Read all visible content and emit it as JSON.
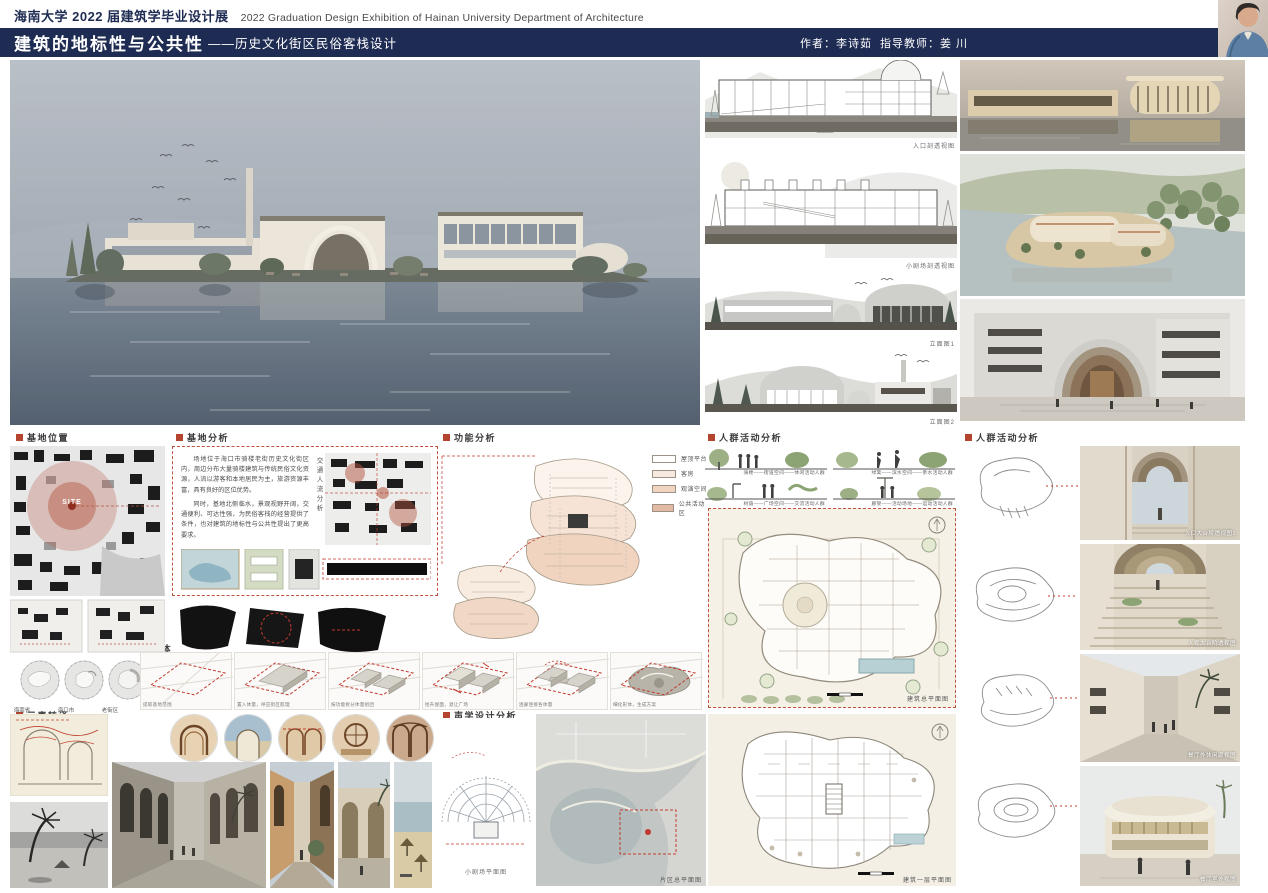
{
  "header": {
    "title_cn": "海南大学 2022 届建筑学毕业设计展",
    "title_en": "2022 Graduation Design Exhibition of Hainan University Department of Architecture"
  },
  "titlebar": {
    "main_title": "建筑的地标性与公共性",
    "subtitle": "——历史文化街区民俗客栈设计",
    "author": "作者：李诗茹",
    "advisor": "指导教师：姜  川"
  },
  "middle_column": {
    "section1_caption": "入口剖透视图",
    "section2_caption": "小剧场剖透视图",
    "elevation1_caption": "立面图1",
    "elevation2_caption": "立面图2"
  },
  "sections": {
    "site_location": "基地位置",
    "site_analysis": "基地分析",
    "function_analysis": "功能分析",
    "crowd_activity_left": "人群活动分析",
    "crowd_activity_right": "人群活动分析",
    "massing": "形体生成分析",
    "element_translation": "元素转译",
    "acoustic": "声学设计分析"
  },
  "site_location": {
    "site_label": "SITE",
    "circle_labels": [
      "海南省",
      "海口市",
      "老街区"
    ]
  },
  "site_analysis": {
    "para1": "场地位于海口市骑楼老街历史文化街区内，周边分布大量骑楼建筑与传统民俗文化资源，人流以游客和本地居民为主，旅游资源丰富，具有良好的区位优势。",
    "para2": "同时，基地北侧临水，景观视野开阔，交通便利、可达性强，为民俗客栈的经营提供了条件，也对建筑的地标性与公共性提出了更高要求。",
    "vertical_label": "交通人流分析"
  },
  "function_analysis": {
    "legend": [
      {
        "label": "屋顶平台",
        "color": "#ffffff"
      },
      {
        "label": "客房",
        "color": "#f6e9de"
      },
      {
        "label": "观演空间",
        "color": "#f0d4bf"
      },
      {
        "label": "公共活动区",
        "color": "#e2b9a2"
      }
    ]
  },
  "crowd_activity": {
    "captions": [
      "骑楼——街道空间——休闲活动人群",
      "树荫——广场空间——交流活动人群",
      "绿篱——滨水空间——亲水活动人群",
      "廊架——活动场地——运动活动人群"
    ]
  },
  "massing": {
    "steps": [
      "提取基地范围",
      "置入体量，呼应街区肌理",
      "按功能拆分体量组团",
      "抬升屋面，退让广场",
      "连廊连接各体量",
      "细化形体，生成方案"
    ]
  },
  "plans": {
    "site_plan_caption": "建筑总平面图",
    "floor_plan_caption": "建筑一层平面图",
    "area_plan_caption": "片区总平面图",
    "theater_plan_caption": "小剧场平面图"
  },
  "renders": {
    "captions": [
      "入口大台阶透视图1",
      "人视大台阶透视图",
      "餐厅外休闲廊视图",
      "餐厅室外视图"
    ]
  }
}
